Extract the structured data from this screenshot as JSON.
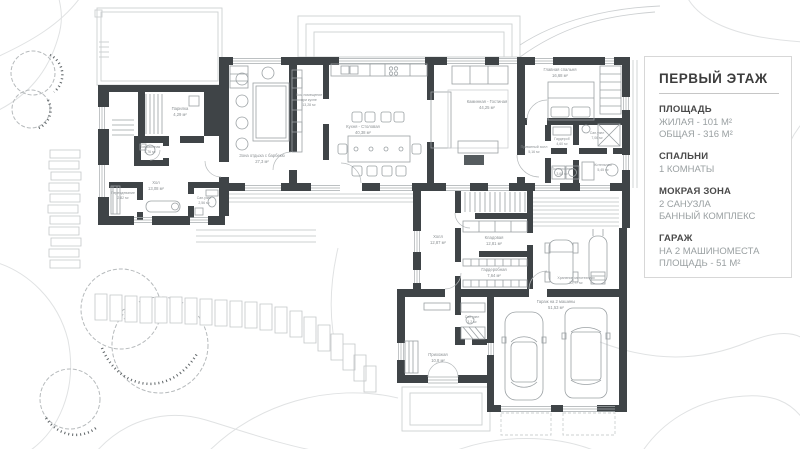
{
  "legend": {
    "title": "ПЕРВЫЙ ЭТАЖ",
    "sections": [
      {
        "header": "ПЛОЩАДЬ",
        "lines": [
          "ЖИЛАЯ - 101 М²",
          "ОБЩАЯ - 316 М²"
        ]
      },
      {
        "header": "СПАЛЬНИ",
        "lines": [
          "1 КОМНАТЫ"
        ]
      },
      {
        "header": "МОКРАЯ ЗОНА",
        "lines": [
          "2 САНУЗЛА",
          "БАННЫЙ КОМПЛЕКС"
        ]
      },
      {
        "header": "ГАРАЖ",
        "lines": [
          "НА 2 МАШИНОМЕСТА",
          "ПЛОЩАДЬ - 51 М²"
        ]
      }
    ]
  },
  "rooms": [
    {
      "name": "Парилка",
      "area": "4,29 м²"
    },
    {
      "name": "Помывочная",
      "area": "3,76 м²"
    },
    {
      "name": "Хол",
      "area": "13,08 м²"
    },
    {
      "name": "Переодевание",
      "area": "2,82 м²"
    },
    {
      "name": "Сан.узел",
      "area": "2,56 м²"
    },
    {
      "name": "Зона отдыха с барбекю",
      "area": "27,3 м²"
    },
    {
      "name": "Хоз. помещение",
      "name2": "при кухне",
      "area": "13,28 м²"
    },
    {
      "name": "Кухня - Столовая",
      "area": "40,38 м²"
    },
    {
      "name": "Каминная - Гостиная",
      "area": "44,25 м²"
    },
    {
      "name": "Главная спальня",
      "area": "16,68 м²"
    },
    {
      "name": "Приватный холл",
      "area": "5,16 м²"
    },
    {
      "name": "Гардероб",
      "area": "4,60 м²"
    },
    {
      "name": "Сан.узел",
      "area": "7,06 м²"
    },
    {
      "name": "Постирочная",
      "area": "3,68 м²"
    },
    {
      "name": "Котельная",
      "area": "5,45 м²"
    },
    {
      "name": "Холл",
      "area": "12,87 м²"
    },
    {
      "name": "Кладовая",
      "area": "12,81 м²"
    },
    {
      "name": "Гардеробная",
      "area": "7,64 м²"
    },
    {
      "name": "Сан.узел",
      "area": "3,2 м²"
    },
    {
      "name": "Прихожая",
      "area": "10,8 м²"
    },
    {
      "name": "Гараж на 2 машины",
      "area": "51,53 м²"
    },
    {
      "name": "Хранение мототехники",
      "area": "22,77 м²"
    }
  ],
  "colors": {
    "wall": "#3f4447",
    "furniture_line": "#9ba1a4",
    "light_line": "#cdd0d2",
    "contour": "#e0e2e3",
    "label": "#8b9093",
    "tree_speckle": "#5d6366"
  }
}
